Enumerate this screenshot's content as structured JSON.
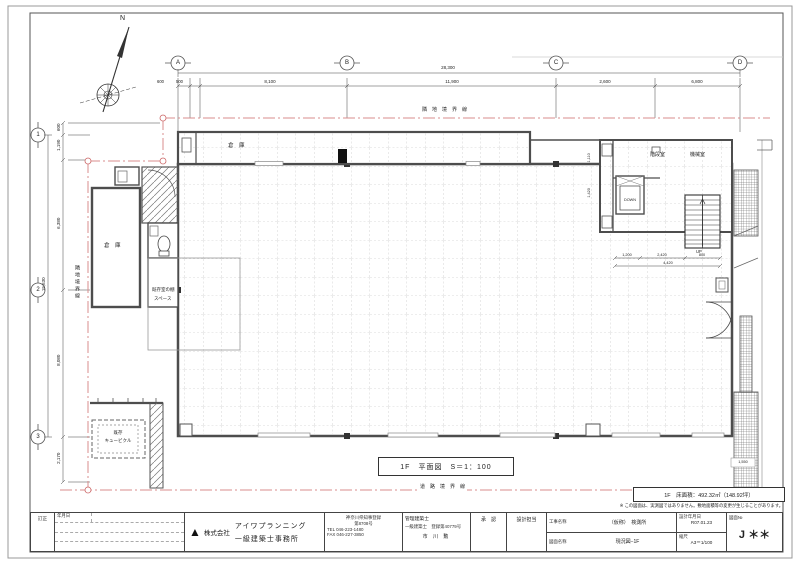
{
  "sheet": {
    "north_label": "N",
    "note": "※ この図面は、実測図ではありません。敷地面積等の変更が生じることがあります。"
  },
  "grid_axes": {
    "cols": [
      "A",
      "B",
      "C",
      "D"
    ],
    "rows": [
      "1",
      "2",
      "3"
    ]
  },
  "boundaries": {
    "top": "隣　地　境　界　線",
    "left": "隣地境界線",
    "bottom": "道　路　境　界　線"
  },
  "dims": {
    "top_total": "28,300",
    "top": [
      "600",
      "500",
      "8,100",
      "11,900",
      "2,600",
      "6,800"
    ],
    "left_total": "15,630",
    "left": [
      "600",
      "1,190",
      "6,380",
      "8,080",
      "2,170"
    ],
    "stair": [
      "1,200",
      "2,420",
      "800"
    ],
    "stair_total": "4,420",
    "ev": [
      "1,110",
      "1,420"
    ],
    "slope": "1,550"
  },
  "rooms": {
    "storage_top": "倉　庫",
    "storage_left": "倉　庫",
    "stair_room": "階段室",
    "machine_room": "機械室",
    "shelf_line1": "既存室の棚",
    "shelf_line2": "スペース",
    "cubicle_line1": "既存",
    "cubicle_line2": "キュービクル",
    "ev_label": "DOWN",
    "up_label": "UP"
  },
  "plan_title": "1F　平面図　S＝1：100",
  "area_note": "1F　床面積：492.32㎡（148.92坪）",
  "title_block": {
    "revision_label": "訂正",
    "date_header": "年月日",
    "logo_glyph": "▲",
    "company_prefix": "株式会社",
    "company_name": "アイワプランニング",
    "company_sub": "一級建築士事務所",
    "registration_line1": "神奈川県知事登録",
    "registration_line2": "第8708号",
    "tel": "TEL 046-223-1480",
    "fax": "FAX 046-227-3850",
    "manager_title": "管理建築士",
    "manager_license": "一級建築士　登録第40779号",
    "manager_name": "市 川 勲",
    "approval_header": "承　認",
    "designer_header": "設計担当",
    "project_label": "工事名称",
    "project_value": "（仮称）　検測所",
    "drawing_label": "図面名称",
    "drawing_value": "現況図−1F",
    "date_label": "設計年月日",
    "date_value": "R07.01.23",
    "scale_label": "縮尺",
    "scale_value": "A3＝1/100",
    "number_label": "図面№",
    "number_value": "J ＊＊"
  }
}
